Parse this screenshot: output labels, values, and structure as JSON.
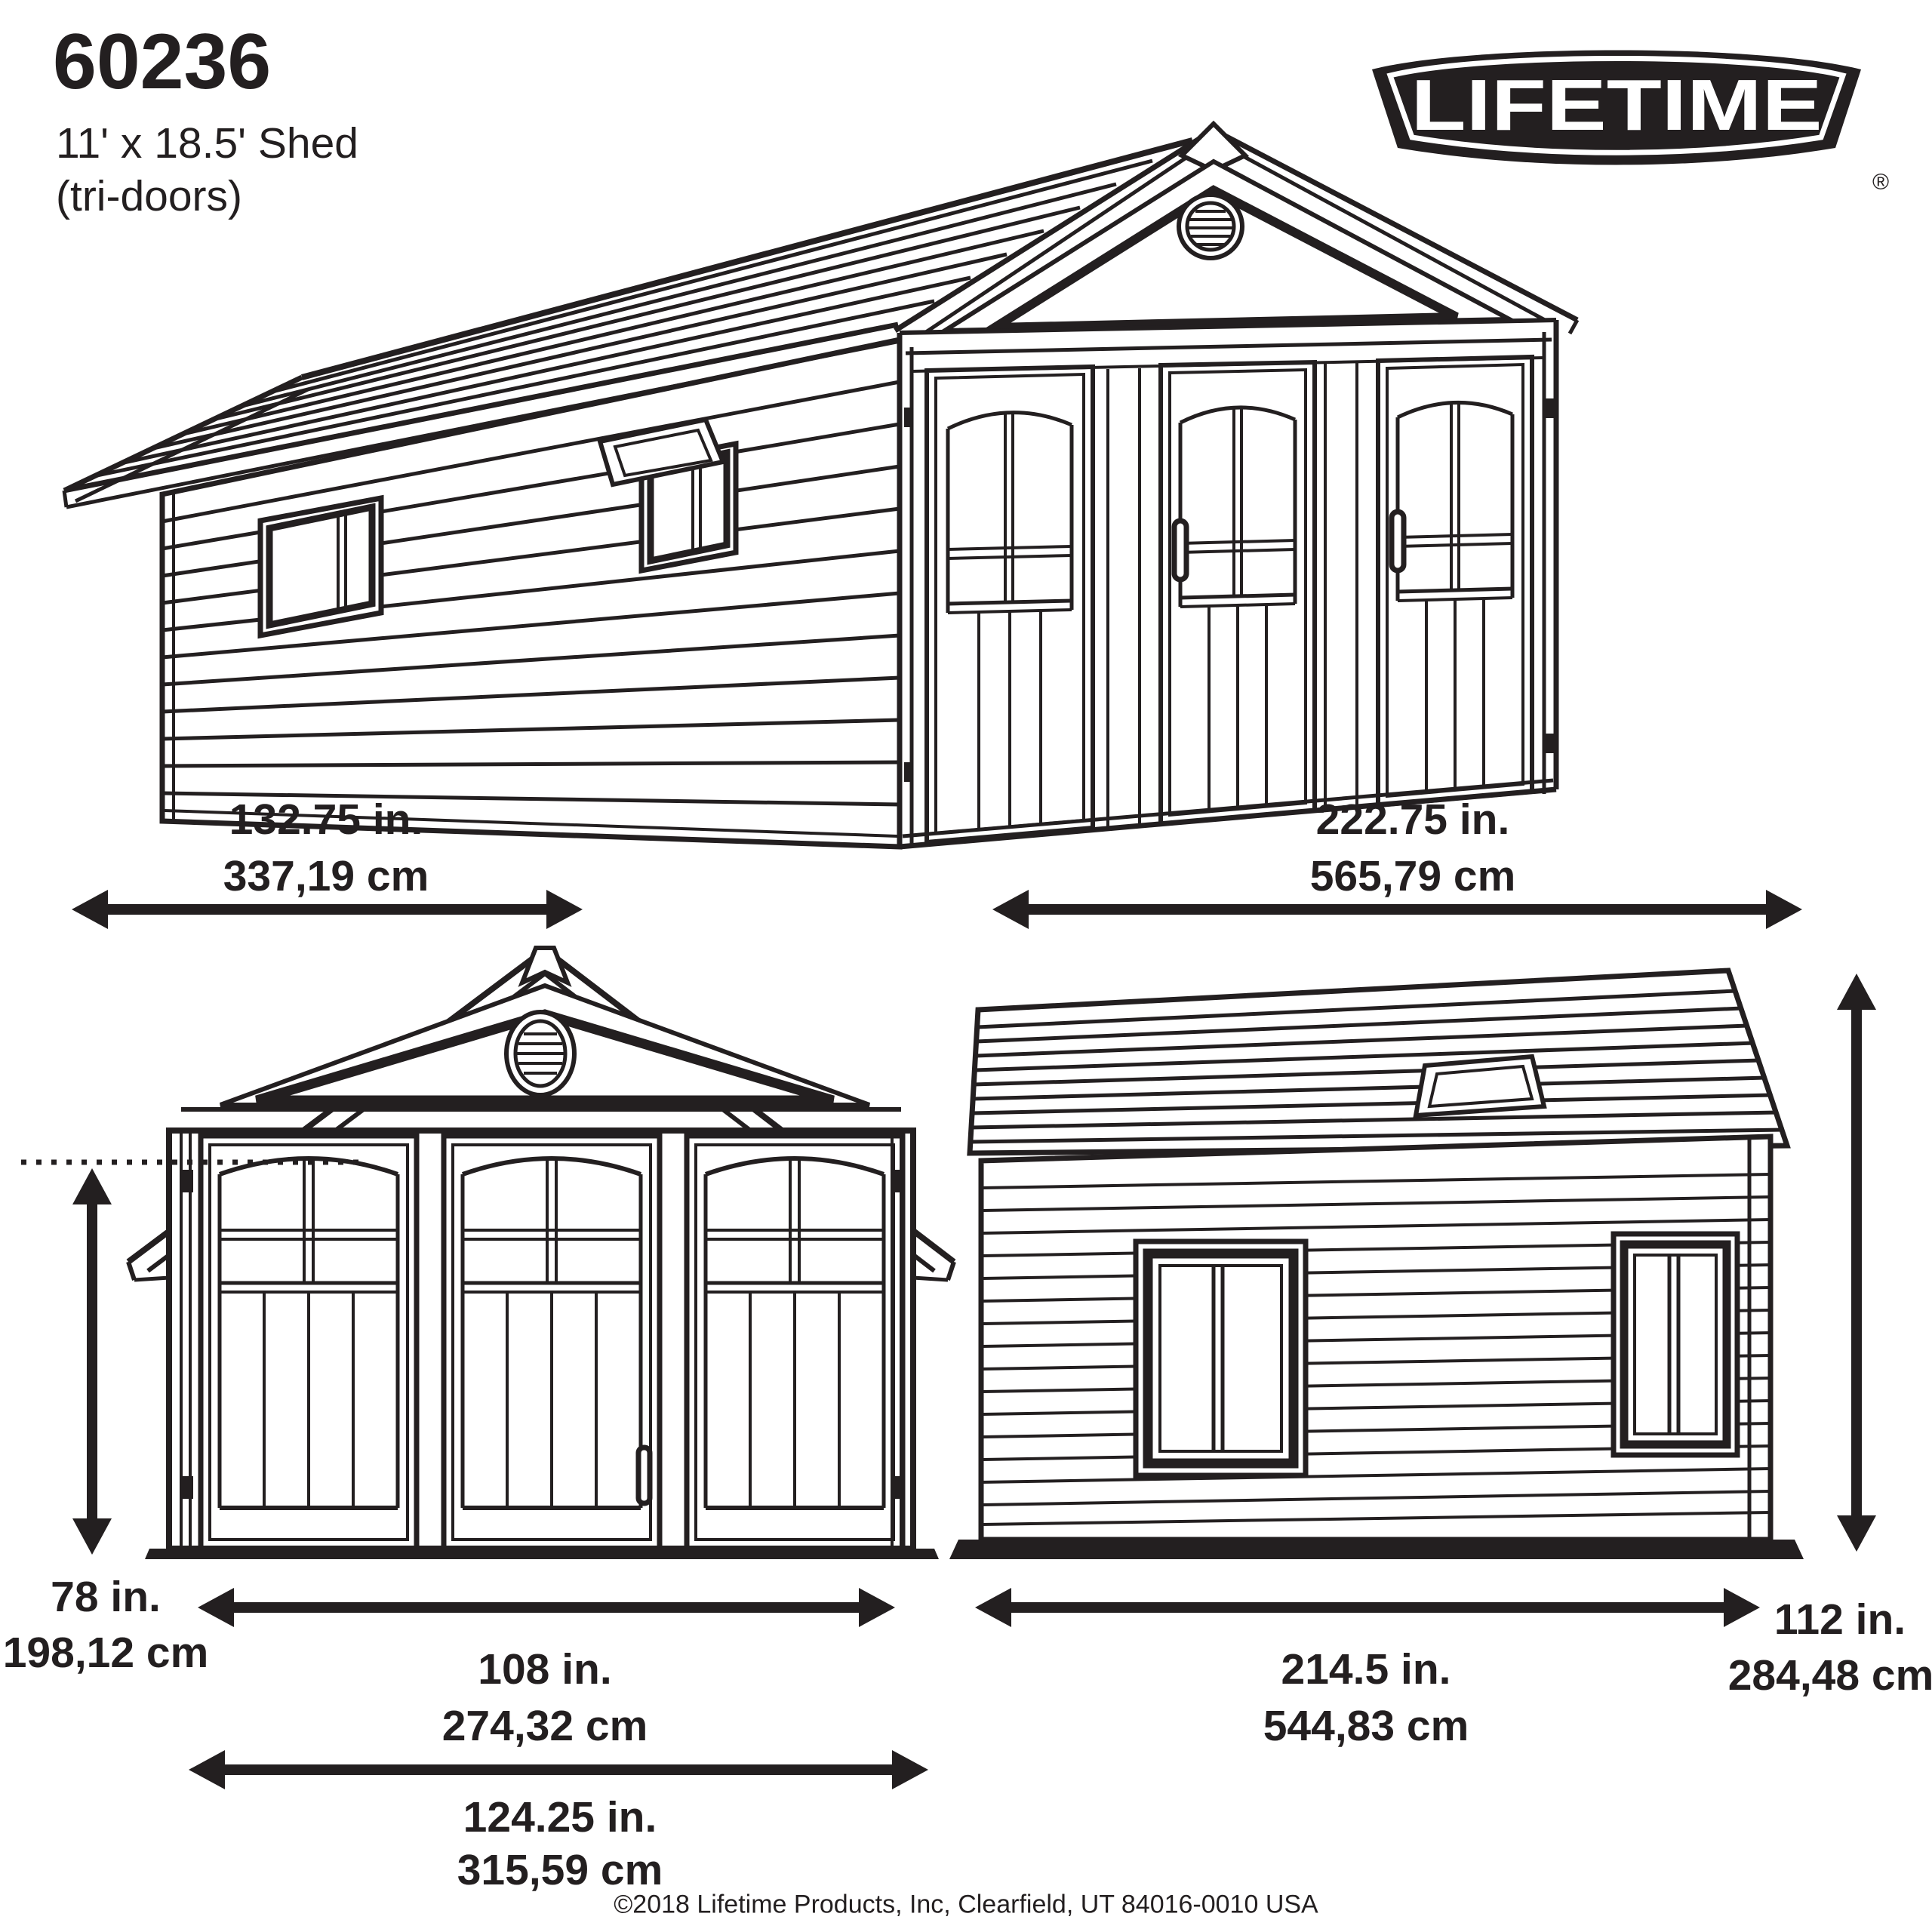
{
  "header": {
    "model_number": "60236",
    "product_size": "11' x 18.5' Shed",
    "product_variant": "(tri-doors)"
  },
  "logo": {
    "text": "LIFETIME",
    "registered_mark": "®"
  },
  "colors": {
    "ink": "#231f20",
    "background": "#ffffff"
  },
  "dimension_labels": {
    "footprint_width": {
      "inches": "132.75 in.",
      "centimeters": "337,19 cm"
    },
    "footprint_length": {
      "inches": "222.75 in.",
      "centimeters": "565,79 cm"
    },
    "front_height": {
      "inches": "78 in.",
      "centimeters": "198,12 cm"
    },
    "front_door_opening_width": {
      "inches": "108 in.",
      "centimeters": "274,32 cm"
    },
    "front_total_width": {
      "inches": "124.25 in.",
      "centimeters": "315,59 cm"
    },
    "side_length": {
      "inches": "214.5 in.",
      "centimeters": "544,83 cm"
    },
    "side_height": {
      "inches": "112 in.",
      "centimeters": "284,48 cm"
    }
  },
  "footer": {
    "copyright": "©2018 Lifetime Products, Inc, Clearfield, UT 84016-0010 USA"
  }
}
